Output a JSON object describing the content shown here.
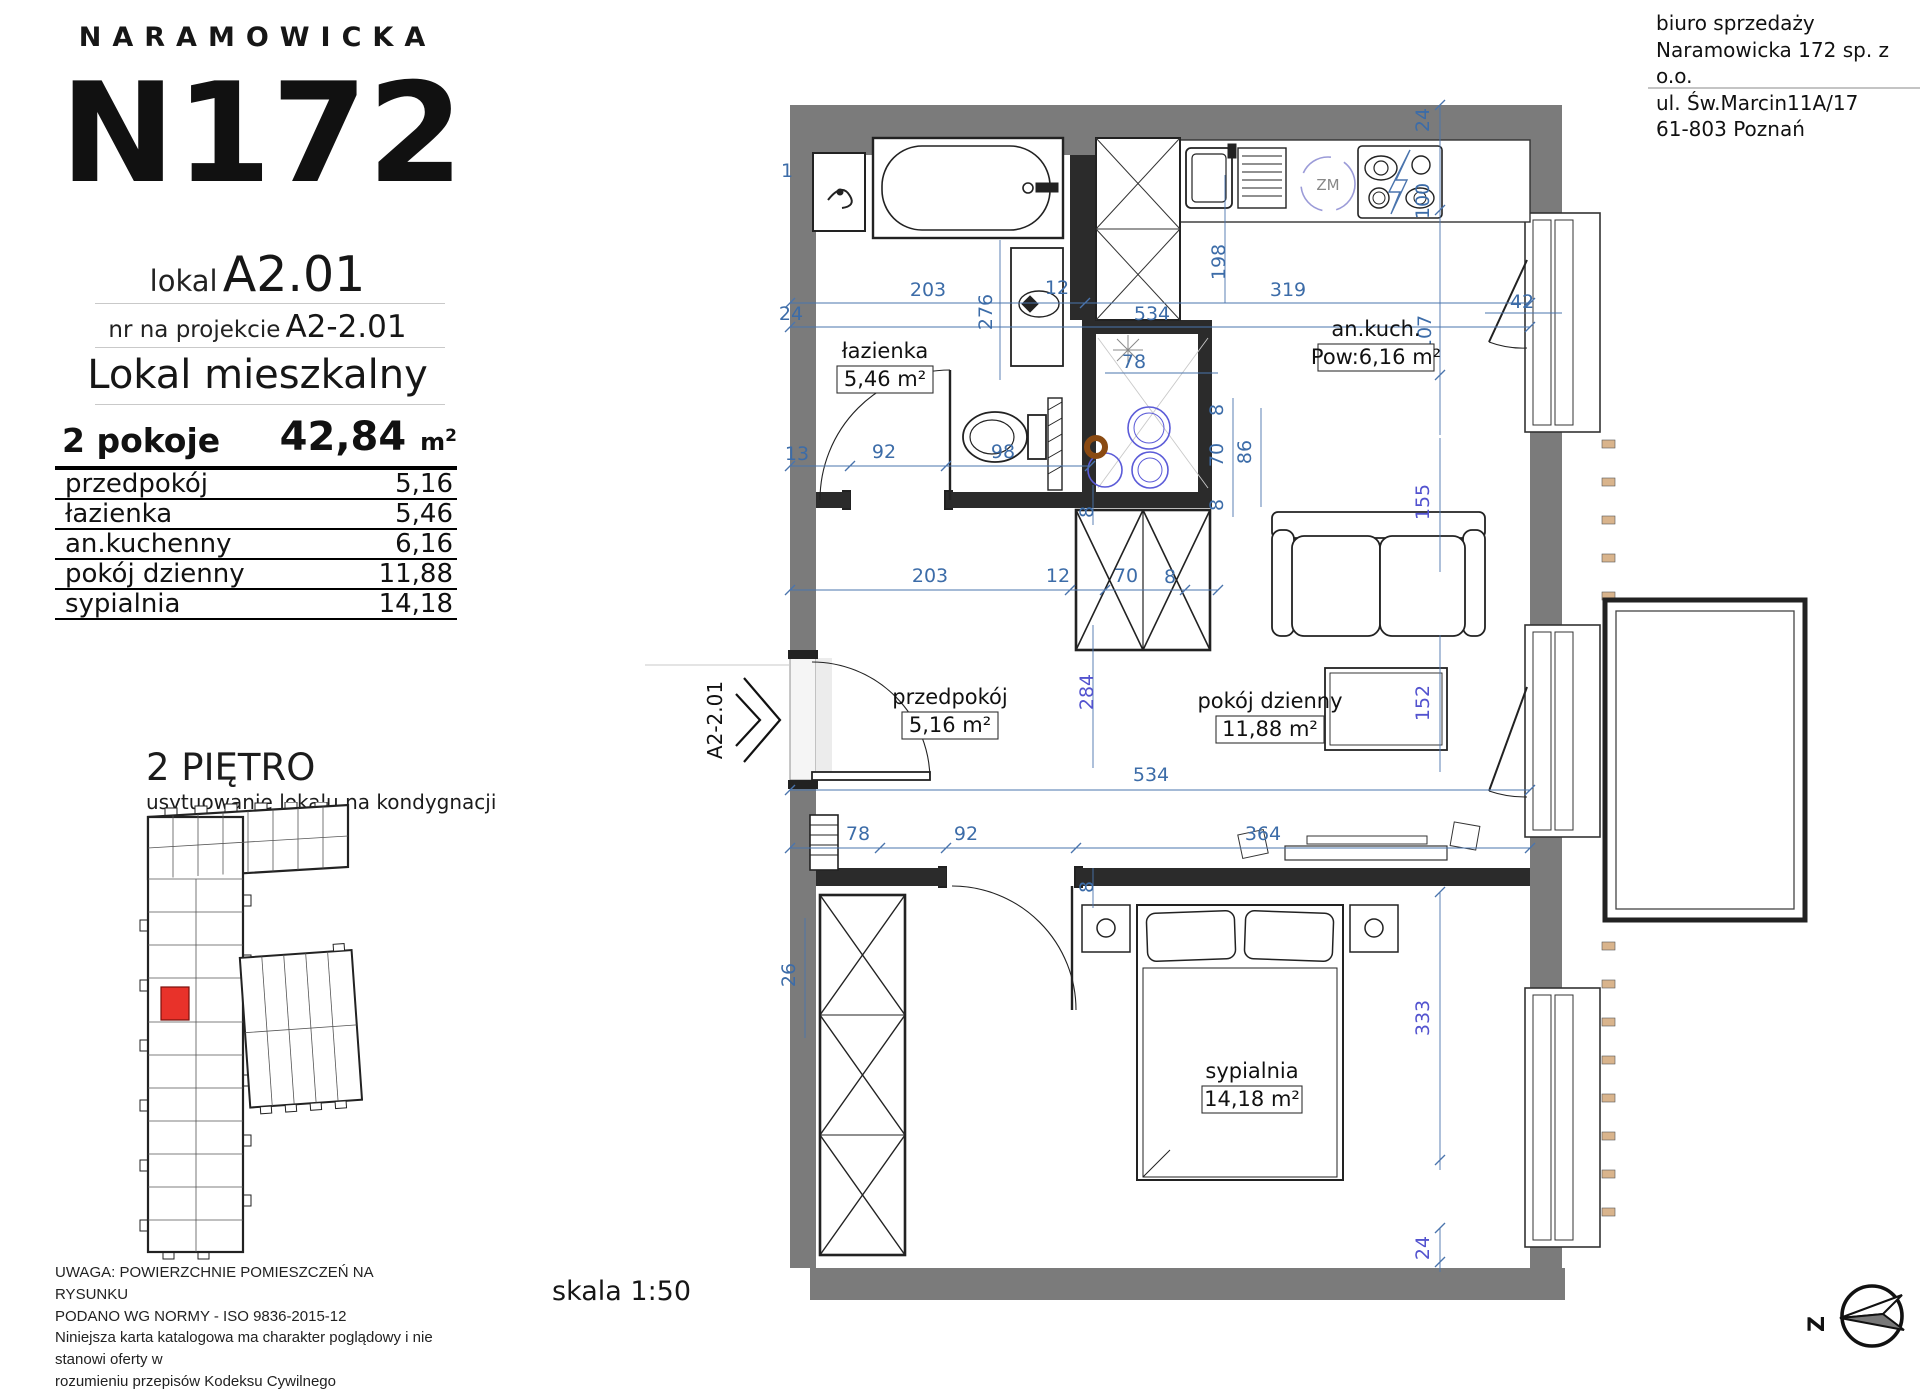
{
  "header": {
    "brand": "NARAMOWICKA",
    "logo": "N172",
    "unit_label": "lokal",
    "unit_value": "A2.01",
    "project_label": "nr na projekcie",
    "project_value": "A2-2.01",
    "type": "Lokal mieszkalny",
    "rooms_count": "2 pokoje",
    "total_area": "42,84",
    "area_unit_base": "m",
    "area_unit_sup": "2"
  },
  "rooms_table": [
    {
      "name": "przedpokój",
      "area": "5,16"
    },
    {
      "name": "łazienka",
      "area": "5,46"
    },
    {
      "name": "an.kuchenny",
      "area": "6,16"
    },
    {
      "name": "pokój dzienny",
      "area": "11,88"
    },
    {
      "name": "sypialnia",
      "area": "14,18"
    }
  ],
  "floor": {
    "title": "2 PIĘTRO",
    "subtitle": "usytuowanie lokalu na kondygnacji"
  },
  "legal": [
    "UWAGA: POWIERZCHNIE POMIESZCZEŃ NA RYSUNKU",
    "PODANO WG NORMY - ISO 9836-2015-12",
    "Niniejsza karta katalogowa ma charakter poglądowy i nie stanowi oferty w",
    "rozumieniu przepisów Kodeksu Cywilnego"
  ],
  "sales_office": [
    "biuro sprzedaży",
    "Naramowicka 172 sp. z o.o.",
    "ul. Św.Marcin11A/17",
    "61-803 Poznań"
  ],
  "plan": {
    "scale_label": "skala 1:50",
    "entrance_code": "A2-2.01",
    "compass_letter": "Z",
    "appliance_symbol": "ZM",
    "rooms": [
      {
        "name": "łazienka",
        "area": "5,46 m²"
      },
      {
        "name": "an.kuch.",
        "area": "Pow:6,16 m²"
      },
      {
        "name": "przedpokój",
        "area": "5,16 m²"
      },
      {
        "name": "pokój dzienny",
        "area": "11,88 m²"
      },
      {
        "name": "sypialnia",
        "area": "14,18 m²"
      }
    ],
    "dims": [
      "1",
      "24",
      "203",
      "12",
      "276",
      "534",
      "319",
      "198",
      "24",
      "100",
      "107",
      "42",
      "13",
      "92",
      "98",
      "78",
      "8",
      "8",
      "70",
      "86",
      "8",
      "155",
      "203",
      "12",
      "70",
      "8",
      "284",
      "152",
      "534",
      "78",
      "92",
      "364",
      "8",
      "26",
      "333",
      "24"
    ]
  },
  "colors": {
    "dim_blue": "#3c6ca8",
    "dim_purple": "#5353cf",
    "wall_gray": "#7b7b7b",
    "wall_dark": "#2b2b2b",
    "unit_red": "#e8322a",
    "wood": "#d9b48c"
  }
}
